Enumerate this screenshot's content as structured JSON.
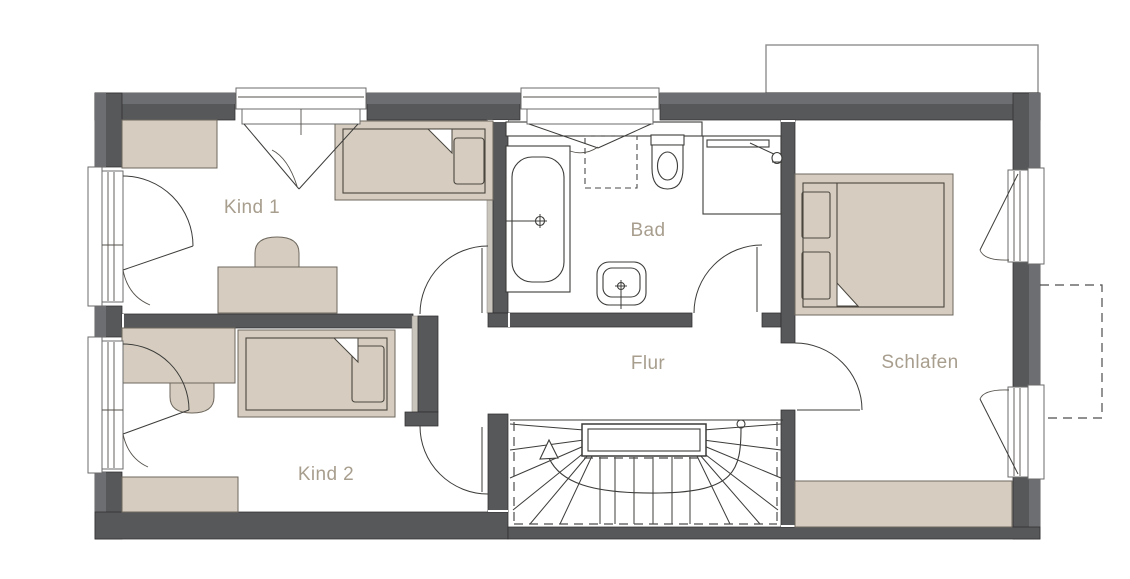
{
  "floorplan": {
    "title": "Obergeschoss Grundriss",
    "rooms": {
      "kind1": {
        "label": "Kind 1"
      },
      "kind2": {
        "label": "Kind 2"
      },
      "bad": {
        "label": "Bad"
      },
      "flur": {
        "label": "Flur"
      },
      "schlafen": {
        "label": "Schlafen"
      }
    },
    "fixtures": [
      "bathtub",
      "shower",
      "toilet",
      "sink",
      "double-bed",
      "single-bed",
      "desk",
      "chair",
      "wardrobe",
      "sideboard",
      "winder-staircase",
      "stair-walk-line",
      "casement-window",
      "door-swing",
      "balcony-outline-dashed",
      "roof-outline"
    ],
    "colors": {
      "wall_dark": "#57585a",
      "wall_light": "#6d6e71",
      "wall_layer_strip": "#c9c4bc",
      "furniture_fill": "#d6cdc0",
      "line": "#3c3c3a",
      "label_text": "#a89e8e",
      "background": "#ffffff"
    }
  }
}
